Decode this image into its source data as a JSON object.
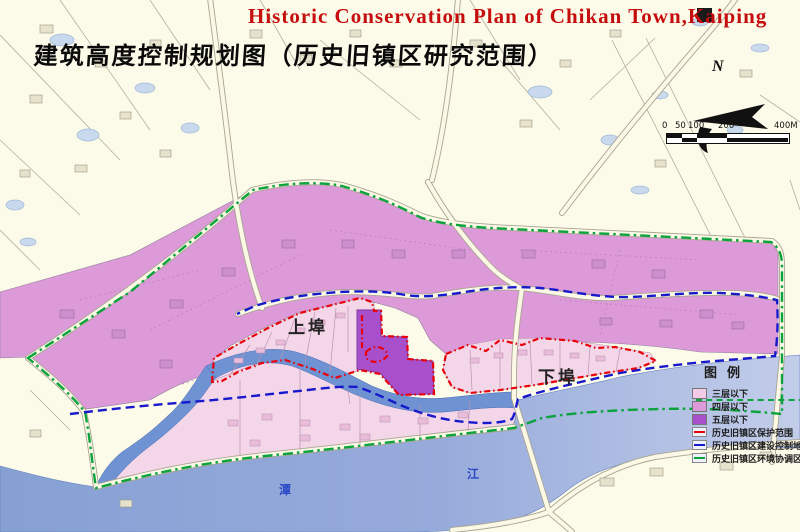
{
  "header": {
    "title_en": "Historic Conservation Plan of Chikan Town,Kaiping",
    "title_zh": "建筑高度控制规划图（历史旧镇区研究范围）"
  },
  "compass": {
    "north_label": "N"
  },
  "scale_bar": {
    "ticks": [
      "0",
      "50",
      "100",
      "200",
      "400M"
    ]
  },
  "map_labels": {
    "upper_town": "上埠",
    "lower_town": "下埠",
    "river_name_char1": "潭",
    "river_name_char2": "江"
  },
  "legend": {
    "title": "图例",
    "area_items": [
      {
        "label": "三层以下",
        "color": "#F4CBE6"
      },
      {
        "label": "四层以下",
        "color": "#DC9AD9"
      },
      {
        "label": "五层以下",
        "color": "#A850CC"
      }
    ],
    "line_items": [
      {
        "label": "历史旧镇区保护范围",
        "color": "#E8000A"
      },
      {
        "label": "历史旧镇区建设控制地带",
        "color": "#1818CC"
      },
      {
        "label": "历史旧镇区环境协调区",
        "color": "#0AA33C"
      }
    ]
  },
  "colors": {
    "background": "#FCFAE8",
    "zone_three_floors": "#F4D6E9",
    "zone_four_floors": "#DC9AD9",
    "zone_five_floors": "#A850CC",
    "river": "#8FA6D8",
    "canal": "#6F92D2",
    "protection_line": "#E8000A",
    "control_line": "#1818CC",
    "coordination_line": "#0AA33C",
    "title_red": "#C50D0D"
  }
}
